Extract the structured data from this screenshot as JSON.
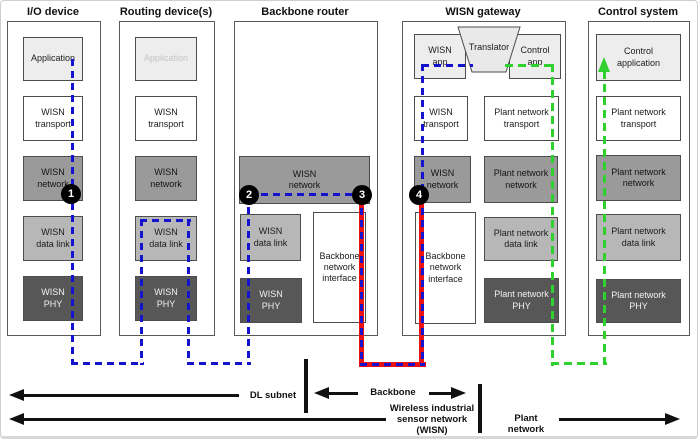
{
  "palette": {
    "wisn_path_blue": "#1414cc",
    "plant_path_green": "#2fd12f",
    "backbone_path_red": "#ee1111",
    "layer_network_gray": "#9a9a9a",
    "layer_datalink_gray": "#b7b7b7",
    "layer_phy_gray": "#575757",
    "app_box_gray": "#ededed"
  },
  "columns": {
    "io_device": {
      "title": "I/O device",
      "layers": {
        "application": "Application",
        "transport": "WISN\ntransport",
        "network": "WISN\nnetwork",
        "data_link": "WISN\ndata link",
        "phy": "WISN\nPHY"
      }
    },
    "routing_device": {
      "title": "Routing device(s)",
      "layers": {
        "application": "Application",
        "transport": "WISN\ntransport",
        "network": "WISN\nnetwork",
        "data_link": "WISN\ndata link",
        "phy": "WISN\nPHY"
      }
    },
    "backbone_router": {
      "title": "Backbone router",
      "layers": {
        "network": "WISN\nnetwork",
        "data_link": "WISN\ndata link",
        "phy": "WISN\nPHY",
        "backbone_interface": "Backbone\nnetwork\ninterface"
      }
    },
    "wisn_gateway": {
      "title": "WISN gateway",
      "layers": {
        "wisn_app": "WISN\napp",
        "translator": "Translator",
        "control_app": "Control\napp",
        "wisn_transport": "WISN\ntransport",
        "plant_transport": "Plant network\ntransport",
        "wisn_network": "WISN\nnetwork",
        "plant_network": "Plant network\nnetwork",
        "backbone_interface": "Backbone\nnetwork\ninterface",
        "plant_data_link": "Plant network\ndata link",
        "plant_phy": "Plant network\nPHY"
      }
    },
    "control_system": {
      "title": "Control system",
      "layers": {
        "application": "Control\napplication",
        "transport": "Plant network\ntransport",
        "network": "Plant network\nnetwork",
        "data_link": "Plant network\ndata link",
        "phy": "Plant network\nPHY"
      }
    }
  },
  "markers": {
    "m1": "1",
    "m2": "2",
    "m3": "3",
    "m4": "4"
  },
  "footer": {
    "dl_subnet": "DL subnet",
    "backbone": "Backbone",
    "wisn": "Wireless industrial\nsensor network (WISN)",
    "plant_network": "Plant network"
  }
}
